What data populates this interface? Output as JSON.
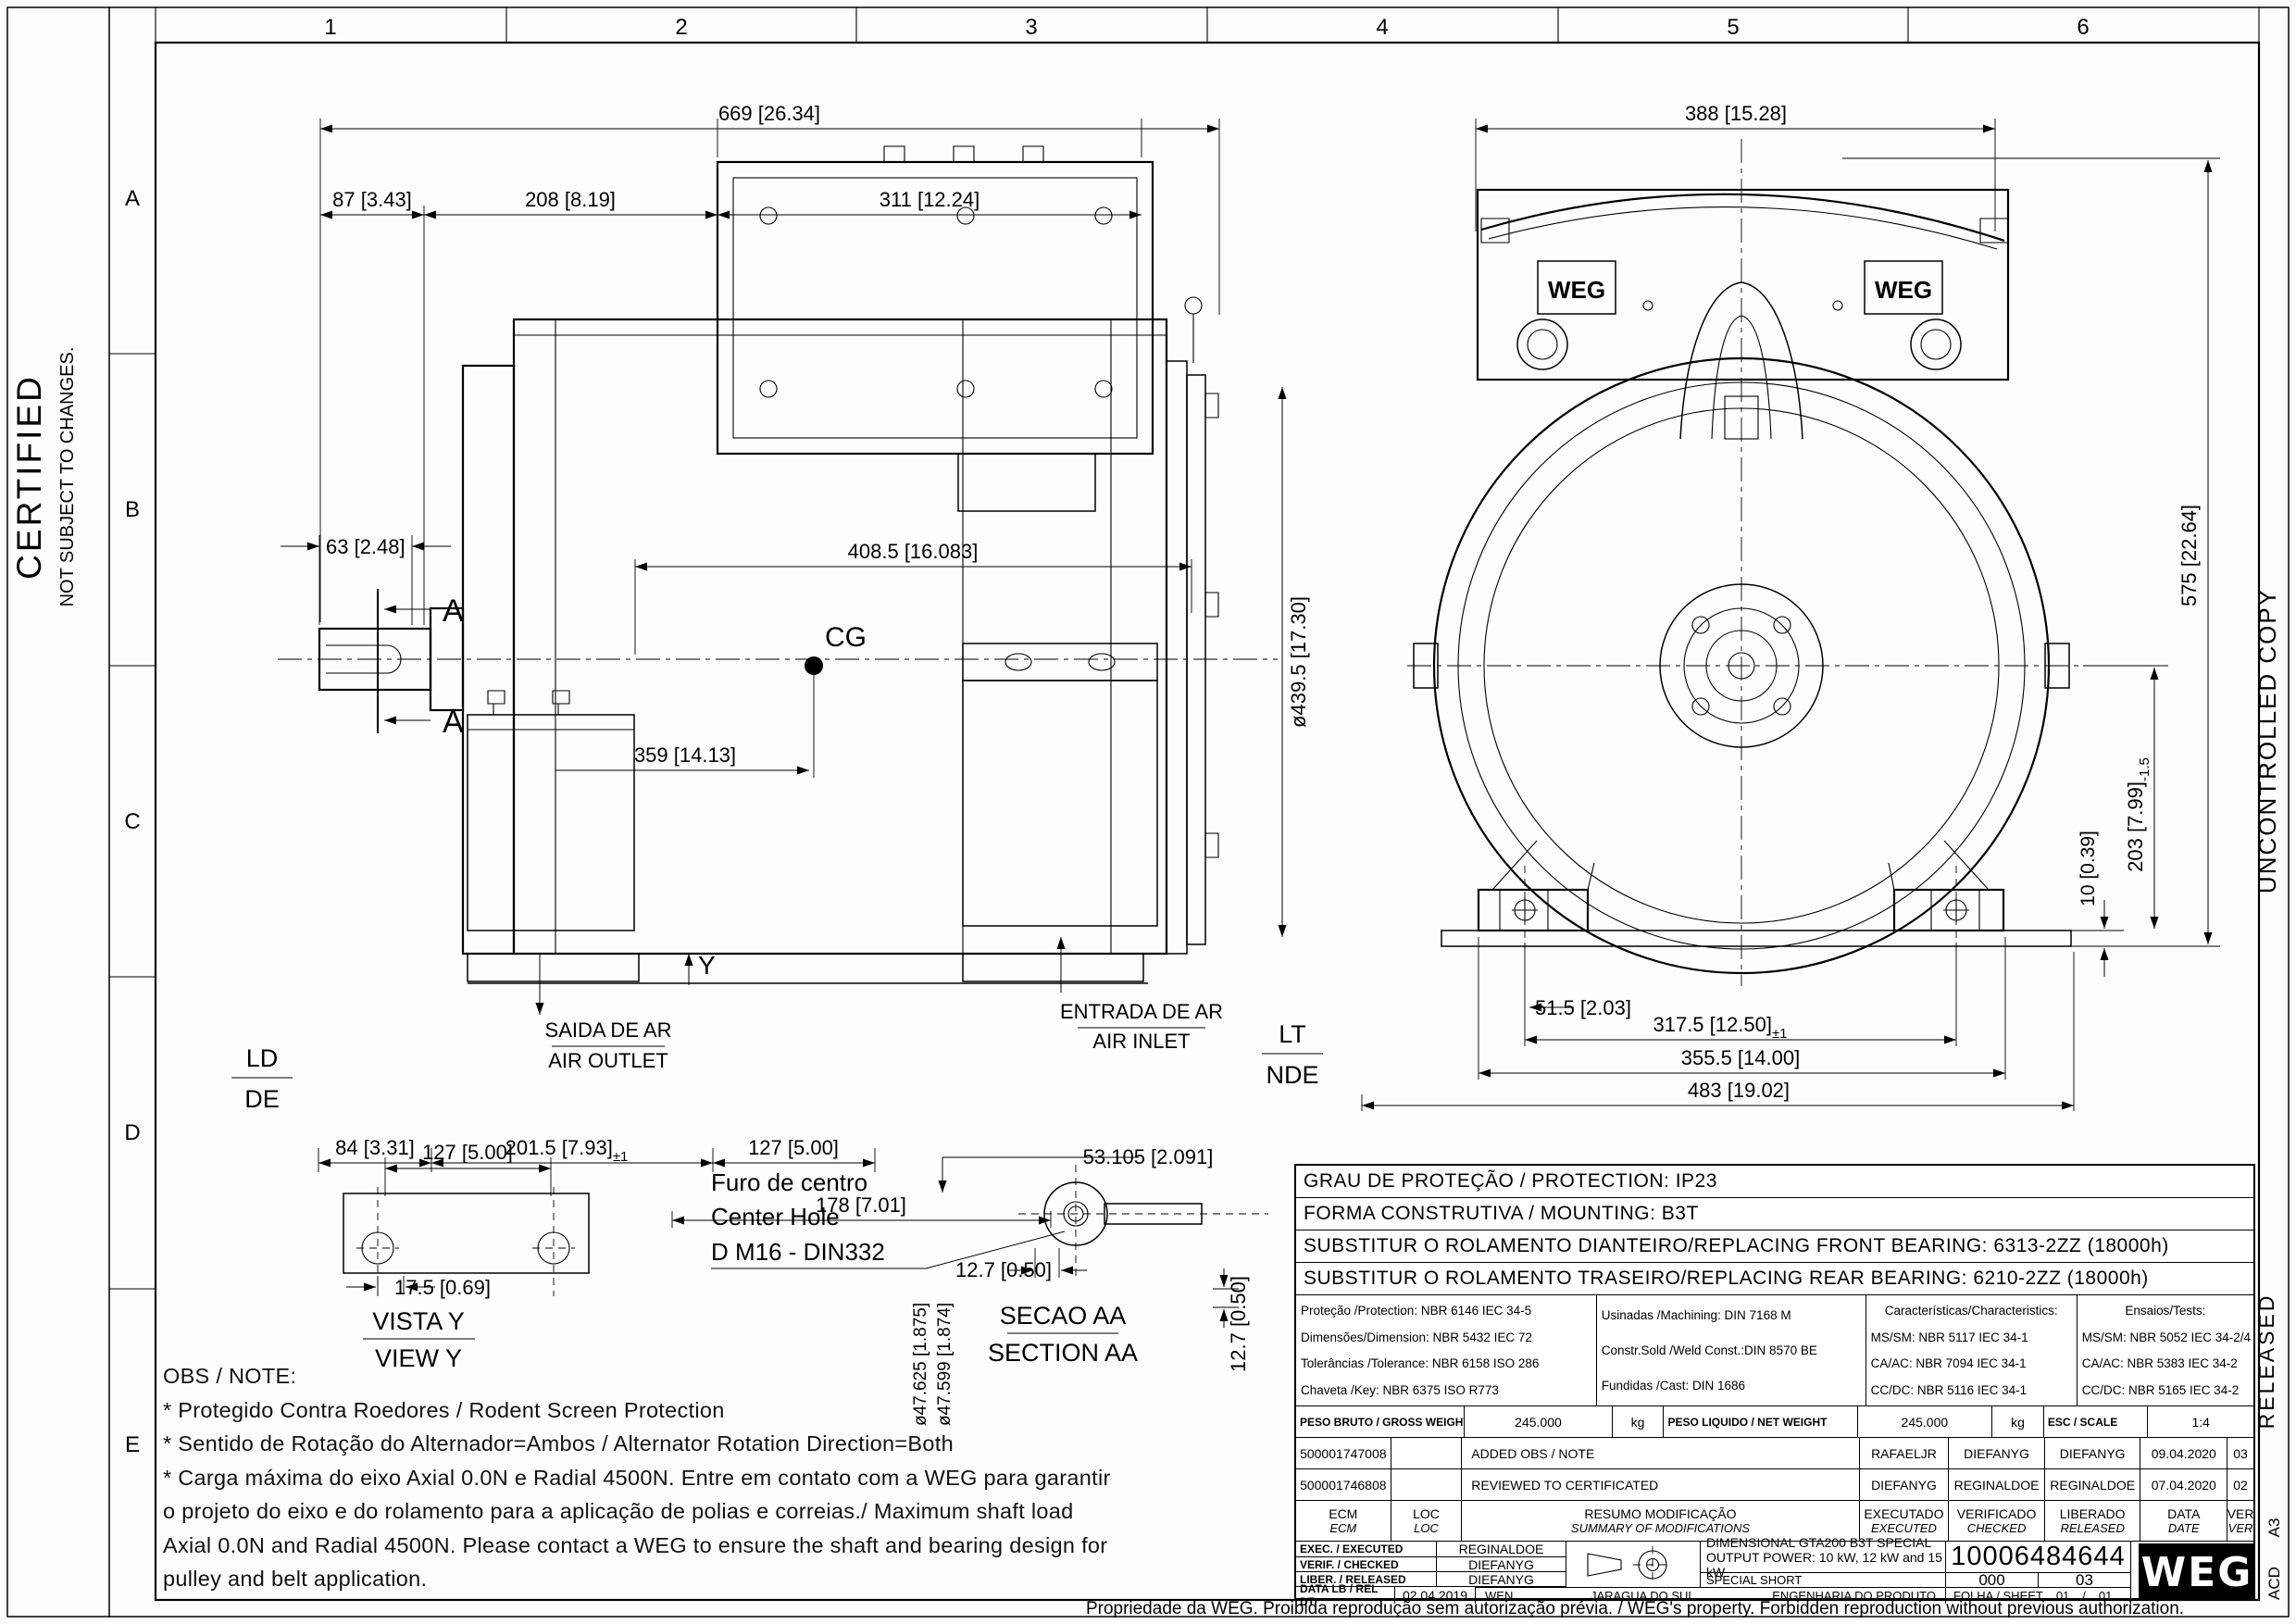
{
  "sheet": {
    "zones": {
      "cols": [
        "1",
        "2",
        "3",
        "4",
        "5",
        "6"
      ],
      "rows": [
        "A",
        "B",
        "C",
        "D",
        "E"
      ]
    },
    "stamps": {
      "certified": "CERTIFIED",
      "not_subject": "NOT SUBJECT TO CHANGES.",
      "uncontrolled": "UNCONTROLLED COPY",
      "released": "RELEASED",
      "a3": "A3",
      "acd": "ACD"
    },
    "footer": "Propriedade da WEG. Proibida reprodução sem autorização prévia. / WEG's property. Forbidden reproduction without previous authorization."
  },
  "drawing": {
    "labels": {
      "cg": "CG",
      "section_mark": "A",
      "y_mark": "Y",
      "ld": "LD",
      "de": "DE",
      "lt": "LT",
      "nde": "NDE",
      "air_outlet_pt": "SAIDA DE AR",
      "air_outlet_en": "AIR OUTLET",
      "air_inlet_pt": "ENTRADA DE AR",
      "air_inlet_en": "AIR INLET",
      "weg": "WEG"
    },
    "dims": {
      "overall_length": "669 [26.34]",
      "shaft_end": "87 [3.43]",
      "front_section": "208 [8.19]",
      "terminal_box": "311 [12.24]",
      "shaft_ext": "63 [2.48]",
      "frame_length": "408.5 [16.083]",
      "cg_position": "359 [14.13]",
      "frame_dia": "ø439.5 [17.30]",
      "foot_front": "84 [3.31]",
      "foot_span": "201.5 [7.93]",
      "foot_span_tol": "±1",
      "foot_hole": "127 [5.00]",
      "foot_rear": "178 [7.01]",
      "rear_width": "388 [15.28]",
      "overall_height": "575 [22.64]",
      "shaft_height": "203 [7.99]",
      "shaft_height_tol": "-1.5",
      "base_thickness": "10 [0.39]",
      "foot_edge": "51.5 [2.03]",
      "foot_holes_span": "317.5 [12.50]",
      "foot_holes_tol": "±1",
      "feet_width": "355.5 [14.00]",
      "overall_width": "483 [19.02]",
      "vista_holes": "127 [5.00]",
      "vista_offset": "17.5 [0.69]",
      "key_length": "53.105 [2.091]",
      "key_width": "12.7 [0.50]",
      "key_height": "12.7 [0.50]",
      "shaft_dia_max": "ø47.625 [1.875]",
      "shaft_dia_min": "ø47.599 [1.874]"
    },
    "details": {
      "vista_pt": "VISTA Y",
      "vista_en": "VIEW Y",
      "secao_pt": "SECAO AA",
      "secao_en": "SECTION AA",
      "hole_pt": "Furo de centro",
      "hole_en": "Center Hole",
      "hole_spec": "D M16 - DIN332"
    }
  },
  "notes": {
    "title": "OBS / NOTE:",
    "lines": [
      "* Protegido Contra Roedores / Rodent Screen Protection",
      "* Sentido de Rotação do Alternador=Ambos / Alternator Rotation Direction=Both",
      "* Carga máxima do eixo Axial 0.0N e Radial 4500N. Entre em contato com a WEG para garantir",
      "o projeto do eixo e do rolamento para a aplicação de polias e correias./ Maximum shaft load",
      "Axial 0.0N and Radial 4500N. Please contact a WEG to ensure the shaft and bearing design for",
      "pulley and belt application."
    ]
  },
  "spec_rows": [
    "GRAU DE PROTEÇÃO / PROTECTION: IP23",
    "FORMA CONSTRUTIVA / MOUNTING: B3T",
    "SUBSTITUR O ROLAMENTO DIANTEIRO/REPLACING FRONT BEARING: 6313-2ZZ (18000h)",
    "SUBSTITUR O ROLAMENTO TRASEIRO/REPLACING REAR BEARING: 6210-2ZZ (18000h)"
  ],
  "standards": {
    "general": [
      "Proteção  /Protection: NBR 6146 IEC 34-5",
      "Dimensões/Dimension: NBR 5432 IEC 72",
      "Tolerâncias /Tolerance:  NBR 6158 ISO 286",
      "Chaveta   /Key:       NBR 6375 ISO R773"
    ],
    "manufacturing": [
      "Usinadas    /Machining:  DIN 7168 M",
      "Constr.Sold /Weld Const.:DIN 8570 BE",
      "Fundidas    /Cast:        DIN 1686"
    ],
    "characteristics": [
      "Características/Characteristics:",
      "MS/SM: NBR 5117 IEC 34-1",
      "CA/AC: NBR 7094 IEC 34-1",
      "CC/DC: NBR 5116 IEC 34-1"
    ],
    "tests": [
      "Ensaios/Tests:",
      "MS/SM: NBR 5052 IEC 34-2/4",
      "CA/AC: NBR 5383 IEC 34-2",
      "CC/DC: NBR 5165 IEC 34-2"
    ]
  },
  "weights": {
    "gross_label": "PESO BRUTO  / GROSS WEIGHT",
    "gross_value": "245.000",
    "gross_unit": "kg",
    "net_label": "PESO LIQUIDO  / NET WEIGHT",
    "net_value": "245.000",
    "net_unit": "kg",
    "scale_label": "ESC    / SCALE",
    "scale_value": "1:4"
  },
  "revisions": {
    "rows": [
      {
        "ecm": "500001747008",
        "loc": "",
        "summary": "ADDED OBS / NOTE",
        "executed": "RAFAELJR",
        "checked": "DIEFANYG",
        "released": "DIEFANYG",
        "date": "09.04.2020",
        "ver": "03"
      },
      {
        "ecm": "500001746808",
        "loc": "",
        "summary": "REVIEWED TO CERTIFICATED",
        "executed": "DIEFANYG",
        "checked": "REGINALDOE",
        "released": "REGINALDOE",
        "date": "07.04.2020",
        "ver": "02"
      }
    ],
    "header": {
      "ecm_pt": "ECM",
      "ecm_en": "ECM",
      "loc_pt": "LOC",
      "loc_en": "LOC",
      "summary_pt": "RESUMO MODIFICAÇÃO",
      "summary_en": "SUMMARY OF MODIFICATIONS",
      "exec_pt": "EXECUTADO",
      "exec_en": "EXECUTED",
      "check_pt": "VERIFICADO",
      "check_en": "CHECKED",
      "rel_pt": "LIBERADO",
      "rel_en": "RELEASED",
      "date_pt": "DATA",
      "date_en": "DATE",
      "ver_pt": "VER",
      "ver_en": "VER"
    }
  },
  "title_block": {
    "exec_label": "EXEC.  / EXECUTED",
    "exec_value": "REGINALDOE",
    "verif_label": "VERIF.  / CHECKED",
    "verif_value": "DIEFANYG",
    "liber_label": "LIBER. / RELEASED",
    "liber_value": "DIEFANYG",
    "date_label": "DATA LB  / REL DT",
    "date_value": "02.04.2019",
    "site_code": "WEN",
    "site": "JARAGUA DO SUL",
    "dept": "ENGENHARIA DO PRODUTO",
    "title1": "DIMENSIONAL GTA200 B3T SPECIAL",
    "title2": "OUTPUT POWER: 10 kW, 12 kW and 15 kW",
    "title3": "SPECIAL SHORT",
    "doc_number": "10006484644",
    "rev_left": "000",
    "rev_right": "03",
    "sheet_label": "FOLHA / SHEET",
    "sheet_value": "01",
    "sheet_sep": "/",
    "sheet_total": "01",
    "logo": "WEG"
  }
}
